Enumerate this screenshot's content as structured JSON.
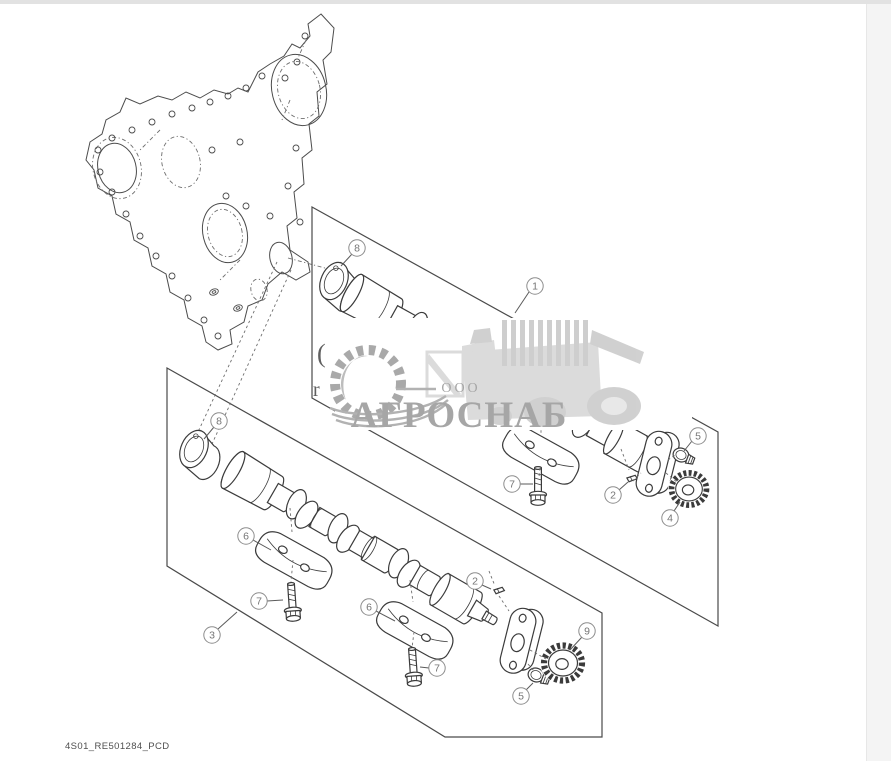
{
  "page": {
    "footer_label": "4S01_RE501284_PCD"
  },
  "watermark": {
    "company_prefix": "ООО",
    "company_name": "АГРОСНАБ"
  },
  "fragments": {
    "glyph1": "(",
    "glyph2": "r"
  },
  "callouts": [
    {
      "number": "8",
      "panel": "top",
      "part": "camshaft-bushing"
    },
    {
      "number": "1",
      "panel": "top",
      "part": "camshaft-assembly"
    },
    {
      "number": "7",
      "panel": "top",
      "part": "cap-screw"
    },
    {
      "number": "2",
      "panel": "top",
      "part": "dowel-pin"
    },
    {
      "number": "5",
      "panel": "top",
      "part": "hex-screw"
    },
    {
      "number": "4",
      "panel": "top",
      "part": "drive-gear"
    },
    {
      "number": "8",
      "panel": "bottom",
      "part": "camshaft-bushing"
    },
    {
      "number": "6",
      "panel": "bottom",
      "part": "bearing-cap"
    },
    {
      "number": "7",
      "panel": "bottom",
      "part": "cap-screw"
    },
    {
      "number": "6",
      "panel": "bottom",
      "part": "bearing-cap"
    },
    {
      "number": "7",
      "panel": "bottom",
      "part": "cap-screw"
    },
    {
      "number": "2",
      "panel": "bottom",
      "part": "dowel-pin"
    },
    {
      "number": "9",
      "panel": "bottom",
      "part": "drive-gear"
    },
    {
      "number": "5",
      "panel": "bottom",
      "part": "hex-screw"
    },
    {
      "number": "3",
      "panel": "bottom",
      "part": "camshaft-assembly"
    }
  ],
  "colors": {
    "line": "#3b3b3b",
    "callout": "#8d8d8d",
    "watermark_text": "#a6a6a6",
    "watermark_art": "#d8d8d8",
    "background": "#ffffff",
    "frame_top": "#e2e2e2",
    "frame_right": "#f4f4f4"
  }
}
